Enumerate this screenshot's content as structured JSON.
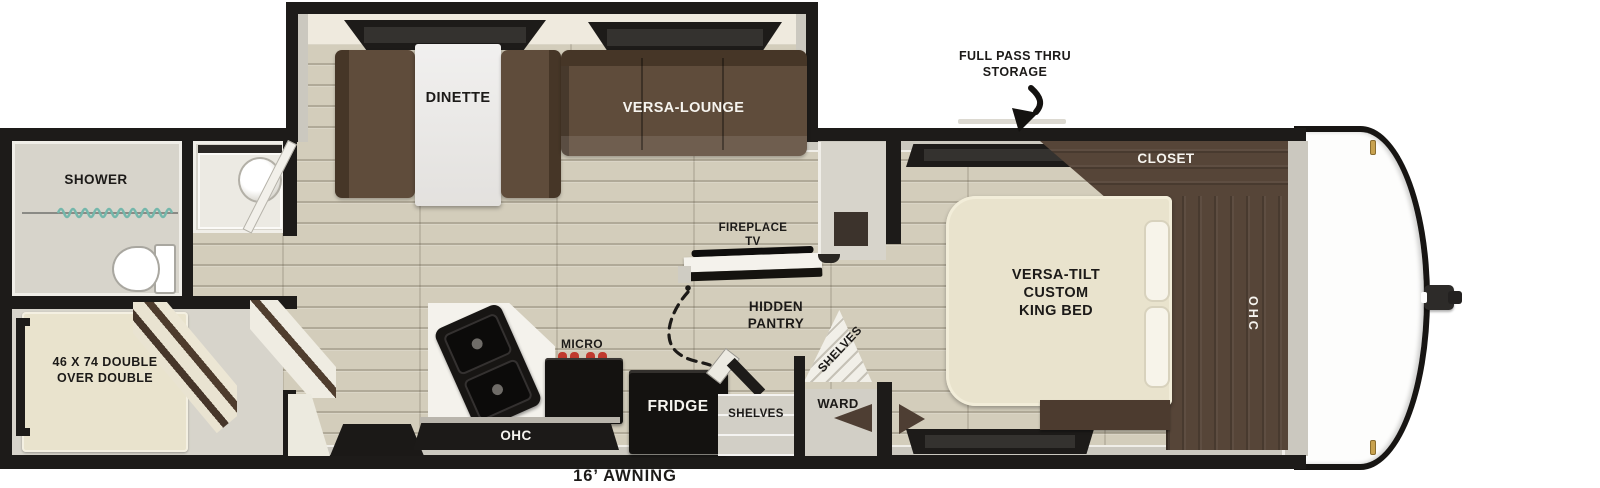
{
  "plan": {
    "exterior": {
      "storage_label": "FULL PASS THRU\nSTORAGE",
      "awning_label": "16’ AWNING"
    },
    "living": {
      "dinette": "DINETTE",
      "versa_lounge": "VERSA-LOUNGE",
      "fireplace_tv": "FIREPLACE\nTV",
      "hidden_pantry": "HIDDEN\nPANTRY"
    },
    "kitchen": {
      "micro": "MICRO",
      "fridge": "FRIDGE",
      "ohc": "OHC",
      "shelves": "SHELVES"
    },
    "bath": {
      "shower": "SHOWER"
    },
    "bunk": {
      "bed": "46 X 74 DOUBLE\nOVER DOUBLE"
    },
    "bedroom": {
      "bed": "VERSA-TILT\nCUSTOM\nKING BED",
      "closet": "CLOSET",
      "ohc": "OHC",
      "ward": "WARD",
      "shelves": "SHELVES"
    }
  },
  "colors": {
    "wall": "#1d1b19",
    "floor": "#d3cdbb",
    "interior": "#d7d4cb",
    "cream": "#efeade",
    "counter": "#f4f2ec",
    "appliance": "#141210",
    "sofa": "#5f4c3b",
    "wood": "#564538",
    "bed": "#e9e3cd",
    "gold": "#c8a24f",
    "burner": "#c03a2e",
    "curtain": "#74b7ab",
    "ink": "#1c1a18",
    "inklight": "#f6f4ef"
  }
}
